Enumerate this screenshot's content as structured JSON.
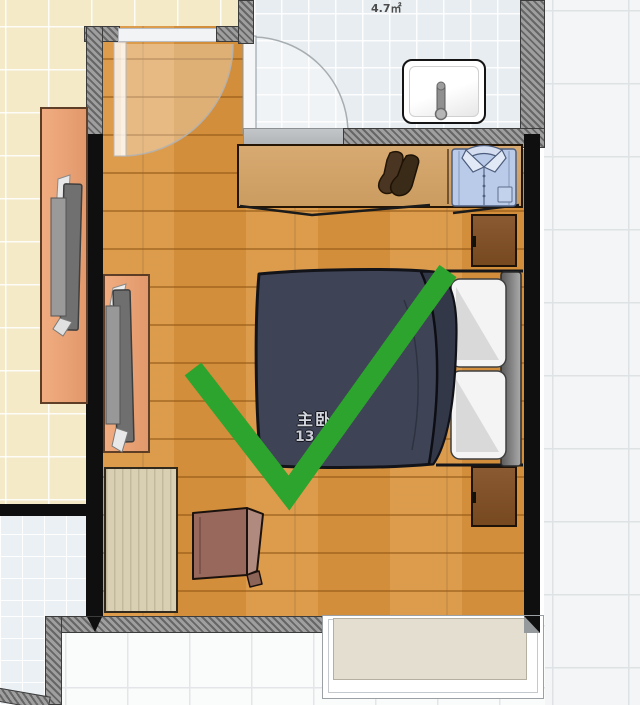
{
  "page": {
    "title": "Bedroom floor plan with green checkmark annotation"
  },
  "labels": {
    "bathroom_area": "4.7㎡",
    "bedroom_name": "主卧",
    "bedroom_area": "13.6"
  },
  "annotation": {
    "shape": "checkmark",
    "color": "#2da42d"
  },
  "rooms": [
    {
      "name": "bedroom",
      "label": "主卧",
      "area": "13.6",
      "floor": "wood-plank"
    },
    {
      "name": "bathroom",
      "area": "4.7㎡",
      "floor": "light-blue-tile"
    },
    {
      "name": "left-room",
      "floor": "beige-tile"
    },
    {
      "name": "right-room",
      "floor": "white-tile-large"
    },
    {
      "name": "bottom-room",
      "floor": "white-tile"
    },
    {
      "name": "bottom-left-room",
      "floor": "light-blue-tile"
    }
  ],
  "furniture": [
    "wardrobe",
    "socks",
    "folded-shirt",
    "sliding-wardrobe-doors",
    "double-bed",
    "duvet",
    "pillow-top",
    "pillow-bottom",
    "headboard",
    "nightstand-top",
    "nightstand-bottom",
    "wash-basin",
    "faucet",
    "tv-cabinet-left",
    "tv-left",
    "tv-cabinet-bedroom",
    "tv-bedroom",
    "desk",
    "chair",
    "bay-window-sill",
    "bedroom-door-swing",
    "bathroom-door-swing"
  ],
  "colors": {
    "wood_floor": "#d9953f",
    "beige_tile": "#f4eac8",
    "bath_tile": "#e7edf0",
    "white_tile": "#fafbfb",
    "wall_black": "#0f0f0f",
    "wall_gray": "#9f9f9f",
    "wardrobe": "#d2a46b",
    "nightstand": "#84552f",
    "duvet_navy": "#3e4356",
    "salmon_cabinet": "#edaa7e",
    "shirt_blue": "#b9cbe8",
    "checkmark_green": "#2da42d"
  }
}
